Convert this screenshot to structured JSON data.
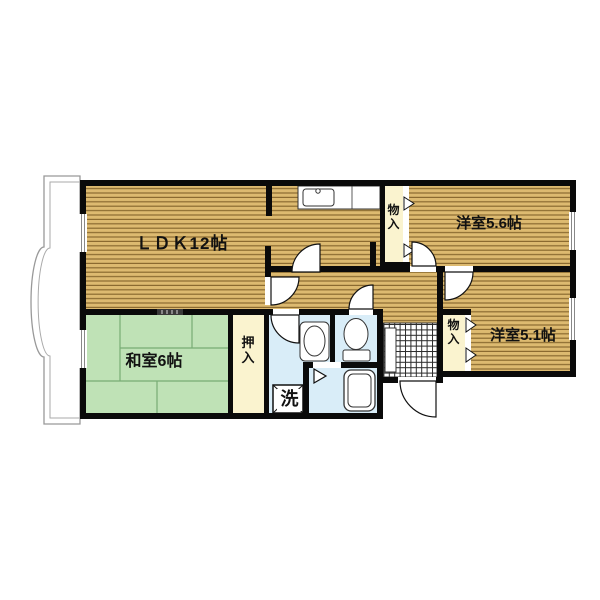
{
  "floorplan": {
    "rooms": {
      "ldk": "ＬＤＫ12帖",
      "western_5_6": "洋室5.6帖",
      "western_5_1": "洋室5.1帖",
      "japanese": "和室6帖",
      "closet": "押入",
      "storage_upper": "物入",
      "storage_lower": "物入",
      "laundry": "洗"
    },
    "colors": {
      "wood": "#ddba70",
      "wood-line": "#8a6a30",
      "tatami": "#bfe2b6",
      "tatami-line": "#77ac74",
      "closet": "#faf3cf",
      "wet": "#d9edf8",
      "wall": "#0a0a0a",
      "outline": "#999999",
      "fixture-line": "#333333"
    }
  }
}
